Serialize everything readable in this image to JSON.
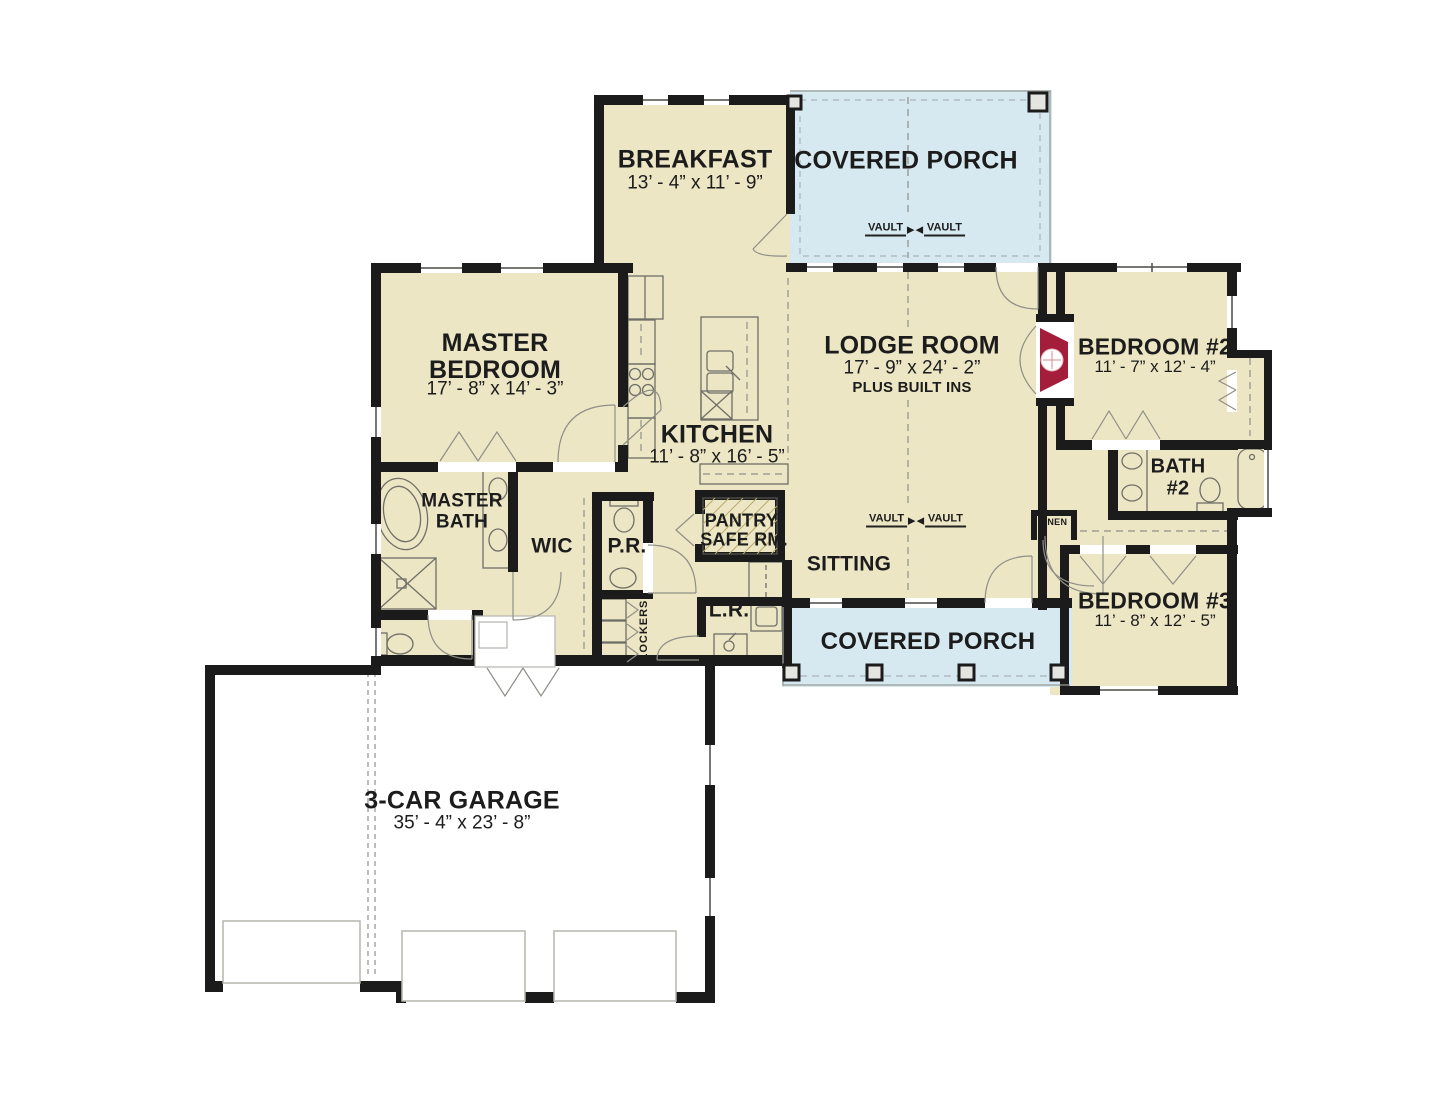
{
  "colors": {
    "wall": "#1b1b1b",
    "room": "#EDE6C4",
    "porch": "#D6E8F0",
    "garage": "#FFFFFF",
    "fireplace": "#A41E3C",
    "line": "#6f6f68",
    "text": "#1c1c1c"
  },
  "rooms": {
    "breakfast": {
      "name": "BREAKFAST",
      "dims": "13’ - 4” x 11’ - 9”"
    },
    "covered_porch_top": {
      "name": "COVERED PORCH"
    },
    "master_bedroom": {
      "name": "MASTER BEDROOM",
      "dims": "17’ - 8” x 14’ - 3”"
    },
    "kitchen": {
      "name": "KITCHEN",
      "dims": "11’ - 8” x 16’ - 5”"
    },
    "lodge_room": {
      "name": "LODGE ROOM",
      "dims": "17’ - 9” x 24’ - 2”",
      "note": "PLUS BUILT INS"
    },
    "bedroom_2": {
      "name": "BEDROOM #2",
      "dims": "11’ - 7” x 12’ - 4”"
    },
    "bath_2": {
      "line1": "BATH",
      "line2": "#2"
    },
    "master_bath": {
      "name": "MASTER BATH"
    },
    "wic": {
      "name": "WIC"
    },
    "powder_room": {
      "name": "P.R."
    },
    "pantry": {
      "line1": "PANTRY/",
      "line2": "SAFE RM."
    },
    "sitting": {
      "name": "SITTING"
    },
    "linen": {
      "name": "LINEN"
    },
    "bedroom_3": {
      "name": "BEDROOM #3",
      "dims": "11’ - 8” x 12’ - 5”"
    },
    "laundry": {
      "name": "L.R."
    },
    "lockers": {
      "name": "LOCKERS"
    },
    "covered_porch_bottom": {
      "name": "COVERED PORCH"
    },
    "garage": {
      "name": "3-CAR GARAGE",
      "dims": "35’ - 4” x 23’ - 8”"
    }
  },
  "annotations": {
    "vault": "VAULT"
  }
}
